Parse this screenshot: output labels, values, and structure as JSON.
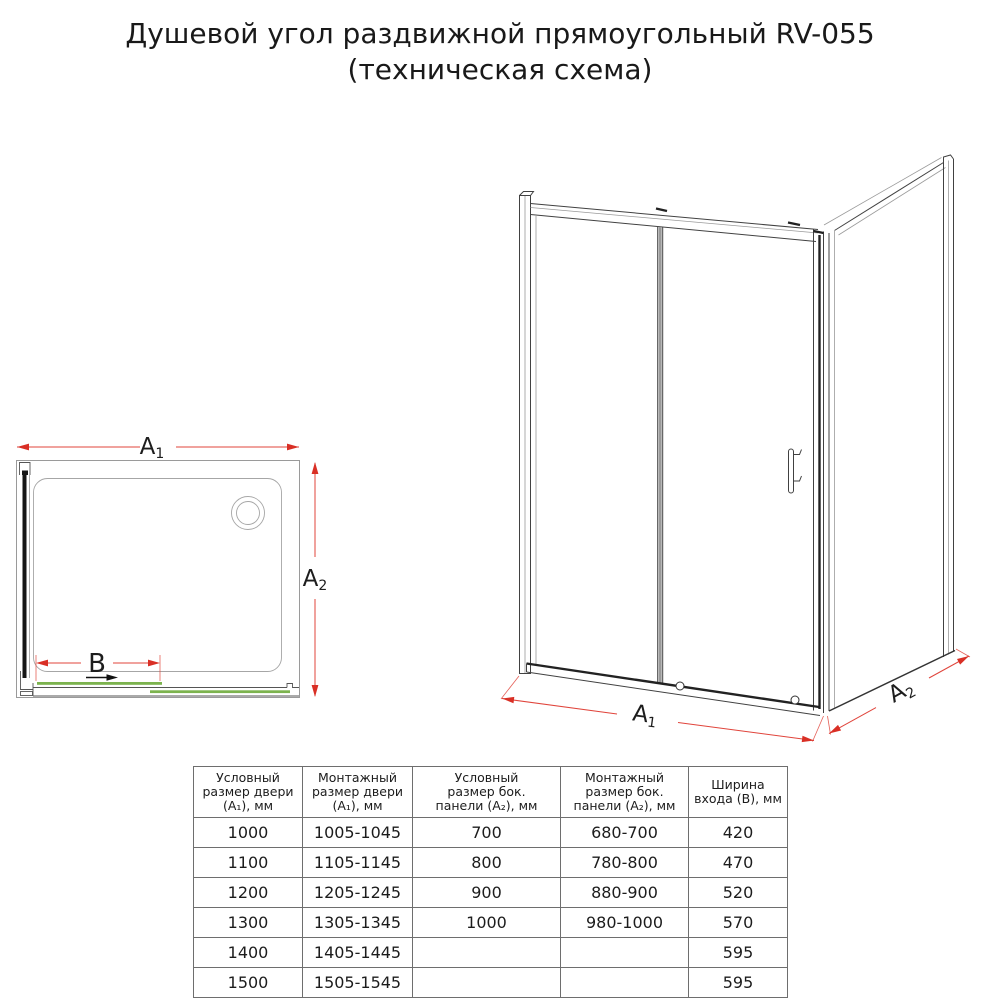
{
  "title": {
    "line1": "Душевой угол раздвижной прямоугольный RV-055",
    "line2": "(техническая схема)"
  },
  "colors": {
    "dim_red": "#e0443b",
    "dim_red_solid": "#d92f25",
    "door_green": "#7cb34e"
  },
  "labels": {
    "a": "A",
    "sub1": "1",
    "sub2": "2",
    "b": "B"
  },
  "table": {
    "headers": [
      [
        "Условный",
        "размер двери",
        "(A₁), мм"
      ],
      [
        "Монтажный",
        "размер двери",
        "(A₁), мм"
      ],
      [
        "Условный",
        "размер бок.",
        "панели (A₂), мм"
      ],
      [
        "Монтажный",
        "размер бок.",
        "панели (A₂), мм"
      ],
      [
        "Ширина",
        "входа (B), мм"
      ]
    ],
    "rows": [
      [
        "1000",
        "1005-1045",
        "700",
        "680-700",
        "420"
      ],
      [
        "1100",
        "1105-1145",
        "800",
        "780-800",
        "470"
      ],
      [
        "1200",
        "1205-1245",
        "900",
        "880-900",
        "520"
      ],
      [
        "1300",
        "1305-1345",
        "1000",
        "980-1000",
        "570"
      ],
      [
        "1400",
        "1405-1445",
        "",
        "",
        "595"
      ],
      [
        "1500",
        "1505-1545",
        "",
        "",
        "595"
      ]
    ]
  }
}
